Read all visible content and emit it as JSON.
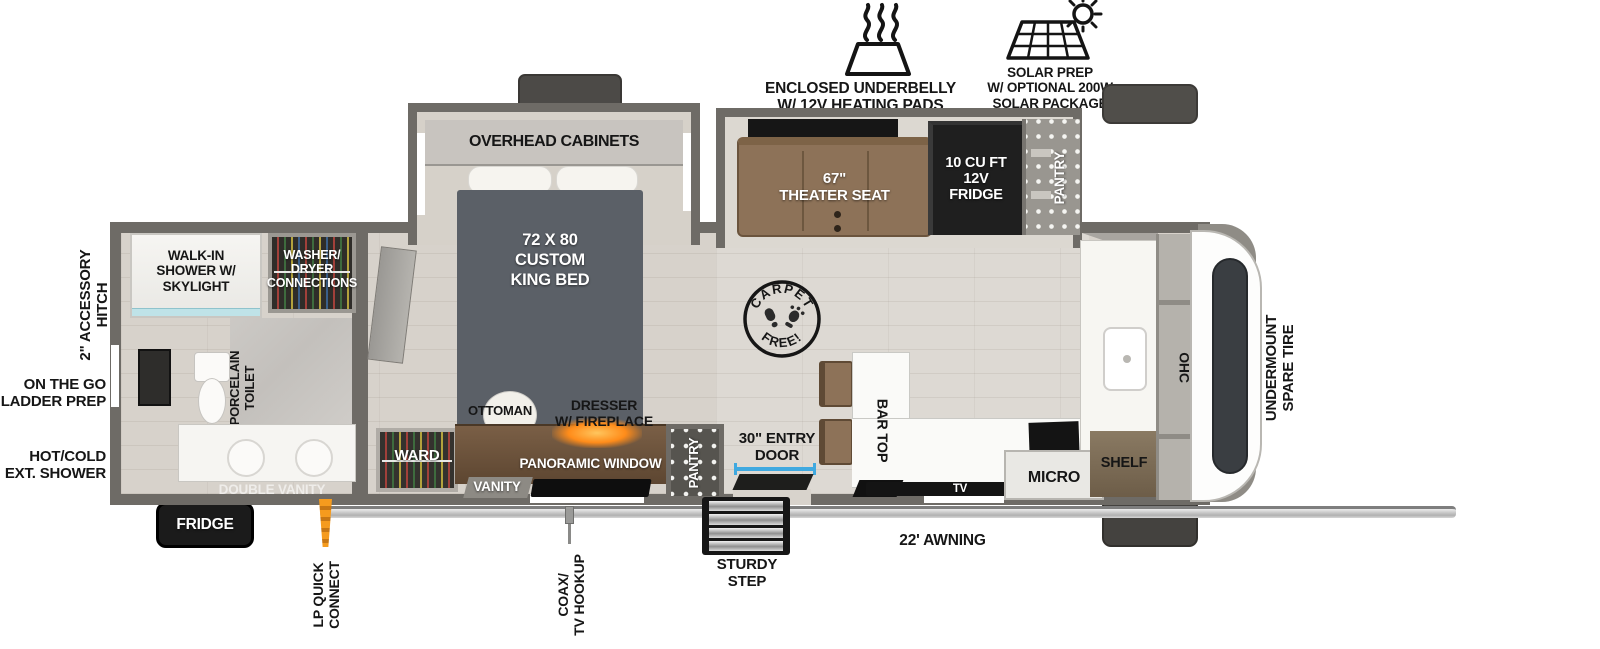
{
  "top_features": {
    "underbelly": "ENCLOSED UNDERBELLY\nW/ 12V HEATING PADS",
    "solar": "SOLAR PREP\nW/ OPTIONAL 200W\nSOLAR PACKAGE"
  },
  "exterior": {
    "hitch": "2\" ACCESSORY\nHITCH",
    "ladder": "ON THE GO\nLADDER PREP",
    "ext_shower": "HOT/COLD\nEXT. SHOWER",
    "fridge": "FRIDGE",
    "lp": "LP QUICK\nCONNECT",
    "coax": "COAX/\nTV HOOKUP",
    "step": "STURDY\nSTEP",
    "awning": "22' AWNING",
    "spare_tire": "UNDERMOUNT\nSPARE TIRE"
  },
  "bathroom": {
    "shower": "WALK-IN\nSHOWER W/\nSKYLIGHT",
    "washer": "WASHER/\nDRYER\nCONNECTIONS",
    "toilet": "PORCELAIN\nTOILET",
    "vanity": "DOUBLE VANITY"
  },
  "bedroom": {
    "ohc": "OVERHEAD CABINETS",
    "bed": "72 X 80\nCUSTOM\nKING BED",
    "ward": "WARD",
    "ottoman": "OTTOMAN",
    "dresser": "DRESSER\nW/ FIREPLACE",
    "window": "PANORAMIC WINDOW",
    "vanity": "VANITY",
    "pantry": "PANTRY"
  },
  "living": {
    "stamp_top": "CARPET",
    "stamp_bottom": "FREE!",
    "door": "30\" ENTRY\nDOOR",
    "bar": "BAR TOP",
    "seat": "67\"\nTHEATER SEAT",
    "fridge": "10 CU FT\n12V\nFRIDGE",
    "pantry": "PANTRY",
    "tv": "TV"
  },
  "kitchen": {
    "micro": "MICRO",
    "shelf": "SHELF",
    "ohc": "OHC"
  },
  "colors": {
    "wall": "#6e6b66",
    "floor": "#d7d2cb",
    "accent_blue": "#3fa9e0",
    "wood": "#7a5f46",
    "seat_brown": "#8d7258",
    "fireplace_glow": "#ff8c1a"
  }
}
